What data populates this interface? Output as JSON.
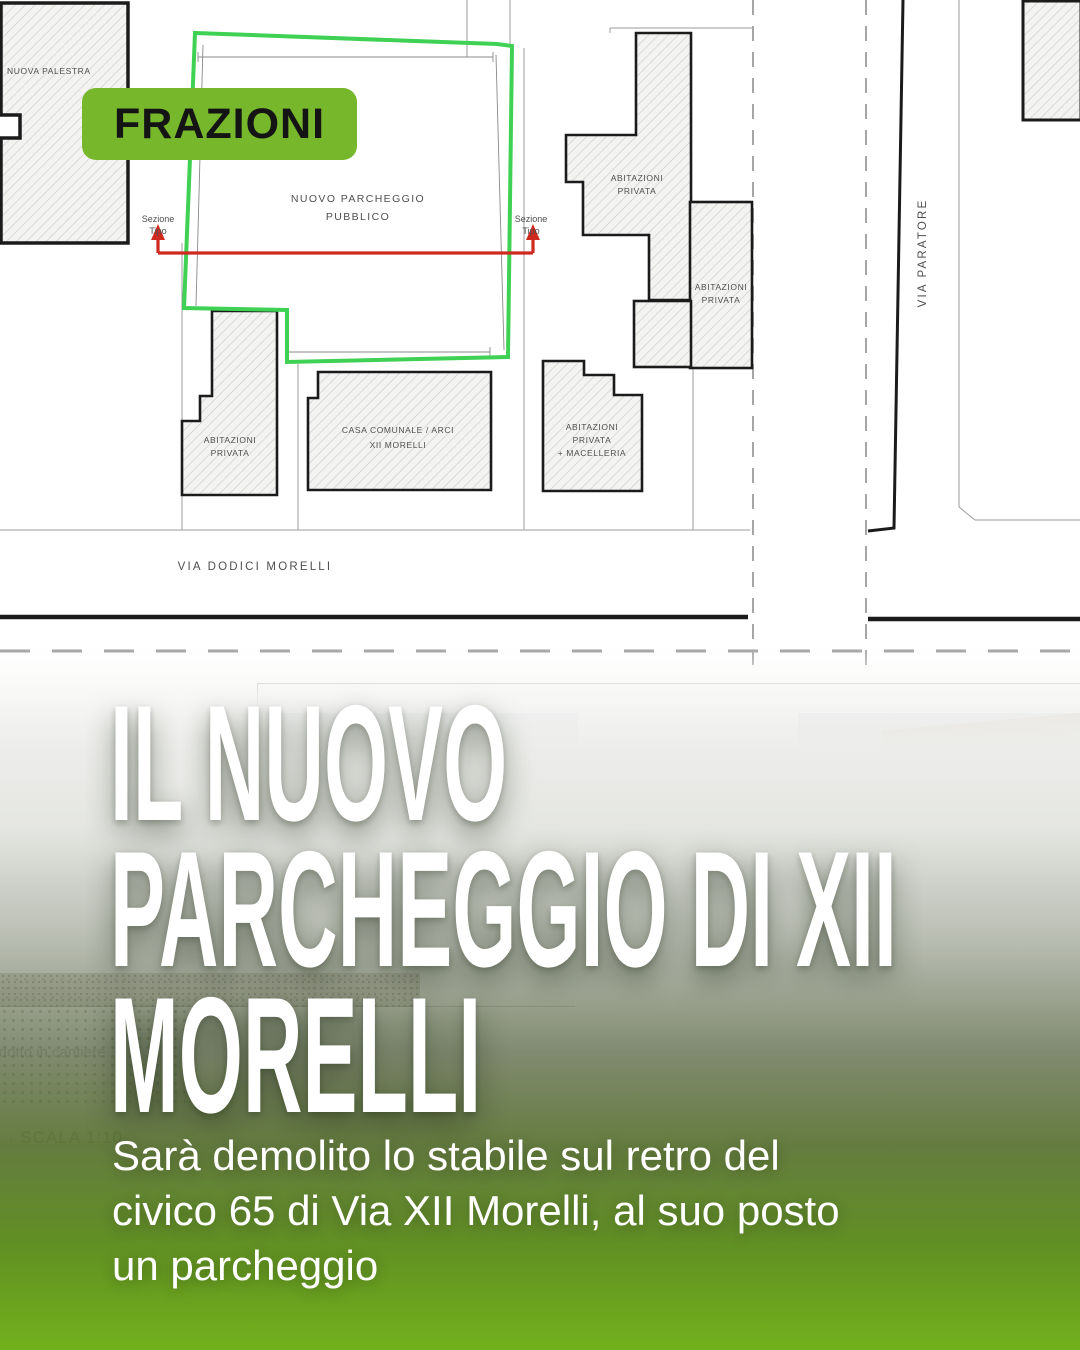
{
  "badge": {
    "label": "FRAZIONI"
  },
  "colors": {
    "badge_green": "#76b72b",
    "parking_outline_green": "#3ed153",
    "section_line_red": "#cf2a20",
    "gradient_green": "#72b11c"
  },
  "plan": {
    "nuova_palestra": "NUOVA PALESTRA",
    "parcheggio_l1": "NUOVO PARCHEGGIO",
    "parcheggio_l2": "PUBBLICO",
    "sezione_l1": "Sezione",
    "sezione_l2": "Tipo",
    "abitazioni_l1": "ABITAZIONI",
    "abitazioni_l2": "PRIVATA",
    "macelleria_l3": "+ MACELLERIA",
    "casa_l1": "CASA COMUNALE / ARCI",
    "casa_l2": "XII MORELLI",
    "via_dodici": "VIA DODICI MORELLI",
    "via_paratore": "VIA PARATORE"
  },
  "sheet": {
    "scala": "· SCALA 1:10",
    "fragment": "ondotto in cantiere"
  },
  "collage": {
    "marker": "1",
    "foto_caption": "FOTO 4"
  },
  "teaser": {
    "title_lines": [
      "IL NUOVO",
      "PARCHEGGIO DI XII",
      "MORELLI"
    ],
    "subtitle_lines": [
      "Sarà demolito lo stabile sul retro del",
      "civico 65 di Via XII Morelli, al suo posto",
      "un parcheggio"
    ]
  }
}
